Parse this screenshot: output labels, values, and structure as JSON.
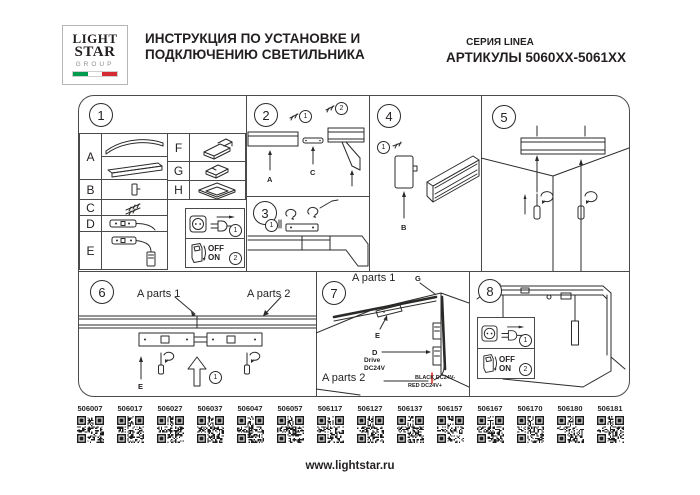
{
  "colors": {
    "ink": "#231f20",
    "red": "#e0342b",
    "flag_green": "#009b4e",
    "flag_red": "#d52b32"
  },
  "header": {
    "logo_line1": "LIGHT",
    "logo_line2": "STAR",
    "logo_line3": "GROUP",
    "title_line1": "ИНСТРУКЦИЯ ПО УСТАНОВКЕ И",
    "title_line2": "ПОДКЛЮЧЕНИЮ СВЕТИЛЬНИКА",
    "series": "СЕРИЯ LINEA",
    "articles": "АРТИКУЛЫ 5060XX-5061XX"
  },
  "panel1": {
    "num": "1",
    "rows_left": [
      "A",
      "B",
      "C",
      "D",
      "E"
    ],
    "rows_right": [
      "F",
      "G",
      "H"
    ],
    "power": {
      "n1": "1",
      "n2": "2",
      "off": "OFF",
      "on": "ON"
    }
  },
  "panel2": {
    "num": "2",
    "n1": "1",
    "n2": "2",
    "label_a": "A",
    "label_c": "C"
  },
  "panel3": {
    "num": "3",
    "n1": "1"
  },
  "panel4": {
    "num": "4",
    "n1": "1",
    "label_b": "B"
  },
  "panel5": {
    "num": "5"
  },
  "panel6": {
    "num": "6",
    "a1": "A parts 1",
    "a2": "A parts 2",
    "label_e": "E",
    "n1": "1"
  },
  "panel7": {
    "num": "7",
    "a1": "A parts 1",
    "a2": "A parts 2",
    "label_g": "G",
    "label_e": "E",
    "label_d": "D",
    "drive_line1": "Drive",
    "drive_line2": "DC24V",
    "wire_black": "BLACK DC24V-",
    "wire_red": "RED DC24V+"
  },
  "panel8": {
    "num": "8",
    "power": {
      "n1": "1",
      "n2": "2",
      "off": "OFF",
      "on": "ON"
    }
  },
  "qr_codes": [
    "506007",
    "506017",
    "506027",
    "506037",
    "506047",
    "506057",
    "506117",
    "506127",
    "506137",
    "506157",
    "506167",
    "506170",
    "506180",
    "506181"
  ],
  "footer": {
    "website": "www.lightstar.ru"
  }
}
